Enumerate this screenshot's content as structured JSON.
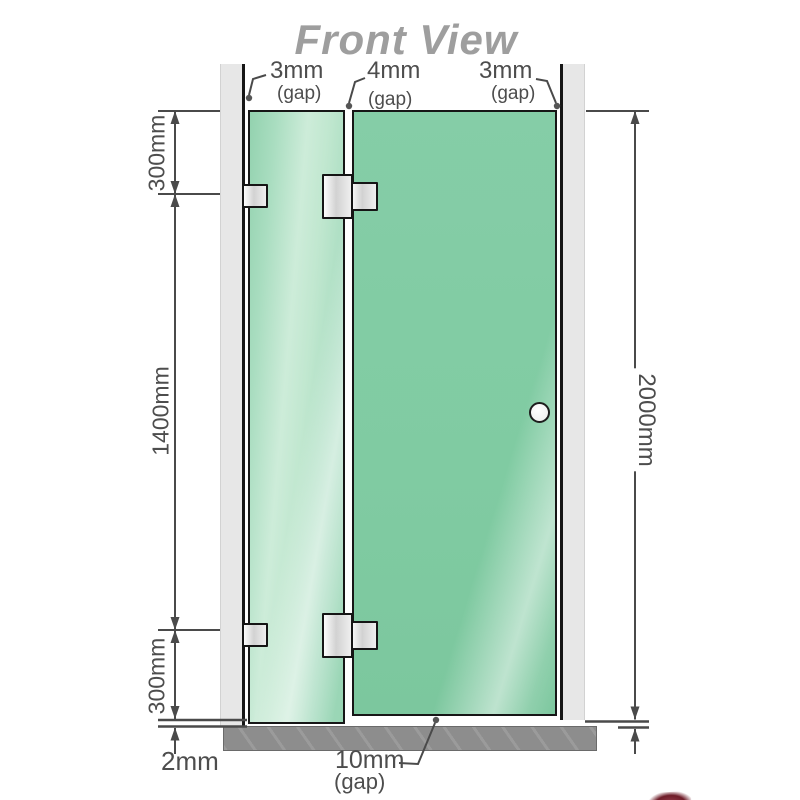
{
  "title": "Front View",
  "colors": {
    "glass": "#84cca5",
    "glass_highlight": "#d2efdd",
    "wall": "#e7e7e7",
    "frame_edge": "#161616",
    "base": "#8d8d8d",
    "title_gray": "#9e9e9e",
    "dim_line": "#4a4a4a",
    "dim_text": "#4d4d4d",
    "logo_red": "#6e1d29"
  },
  "dimensions": {
    "top_gaps": [
      {
        "value": "3mm",
        "note": "(gap)"
      },
      {
        "value": "4mm",
        "note": "(gap)"
      },
      {
        "value": "3mm",
        "note": "(gap)"
      }
    ],
    "left_top": "300mm",
    "left_middle": "1400mm",
    "left_bottom": "300mm",
    "right_height": "2000mm",
    "floor_gap": "2mm",
    "door_bottom_gap": {
      "value": "10mm",
      "note": "(gap)"
    }
  }
}
